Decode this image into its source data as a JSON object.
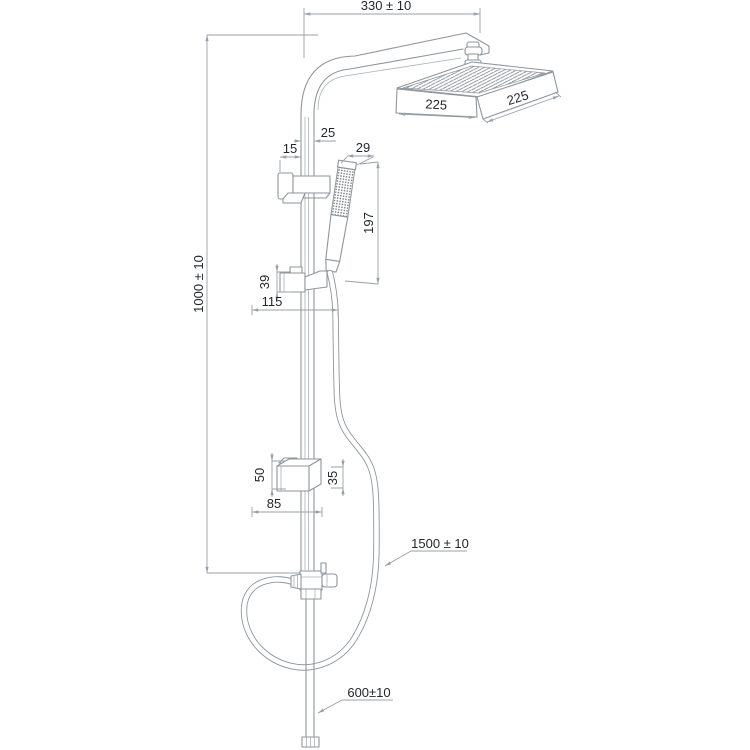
{
  "drawing": {
    "name": "Shower column technical drawing",
    "background": "#ffffff",
    "colors": {
      "outline": "#8f969b",
      "dimension_line": "#98a0a5",
      "dimension_text": "#24272a"
    },
    "dims": {
      "top_width": "330 ± 10",
      "column_height": "1000 ± 10",
      "head_front_width": "225",
      "head_side_depth": "225",
      "pipe_offset": "25",
      "wall_offset": "15",
      "hand_shower_width": "29",
      "hand_shower_length": "197",
      "slider_bracket_height": "39",
      "slider_bracket_offset": "115",
      "lower_bracket_height": "50",
      "lower_bracket_width": "35",
      "lower_bracket_offset": "85",
      "hose_length": "1500 ± 10",
      "outlet_hose_length": "600±10"
    }
  }
}
